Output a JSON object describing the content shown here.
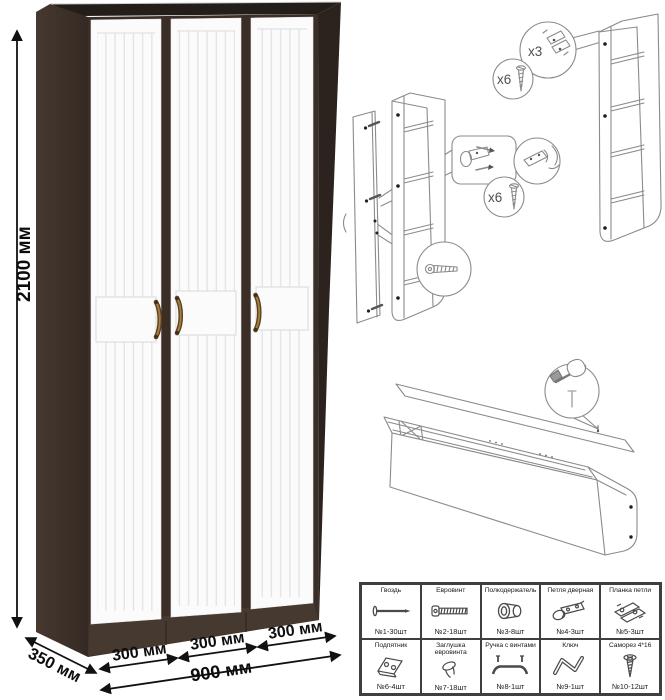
{
  "dimensions": {
    "height": "2100 мм",
    "depth": "350 мм",
    "door_width_1": "300 мм",
    "door_width_2": "300 мм",
    "door_width_3": "300 мм",
    "total_width": "900 мм"
  },
  "assembly": {
    "hinge_plate_qty": "x3",
    "screw_qty_top": "x6",
    "screw_qty_mid": "x6"
  },
  "colors": {
    "wenge_front": "#3a2e27",
    "wenge_top": "#241e1a",
    "wenge_side": "#413329",
    "wenge_right": "#2c231e",
    "plinth": "#463930",
    "door_white": "#fbfbfb",
    "handle_dark": "#5a4122",
    "handle_light": "#a6813e",
    "diagram_line": "#8b8b8b"
  },
  "parts_table": {
    "items": [
      {
        "name": "Гвоздь",
        "count": "№1-30шт",
        "icon": "nail"
      },
      {
        "name": "Евровинт",
        "count": "№2-18шт",
        "icon": "euro-screw"
      },
      {
        "name": "Полкодержатель",
        "count": "№3-8шт",
        "icon": "shelf-support"
      },
      {
        "name": "Петля дверная",
        "count": "№4-3шт",
        "icon": "door-hinge"
      },
      {
        "name": "Планка петли",
        "count": "№5-3шт",
        "icon": "hinge-plate"
      },
      {
        "name": "Подпятник",
        "count": "№6-4шт",
        "icon": "foot-glide"
      },
      {
        "name": "Заглушка евровинта",
        "count": "№7-18шт",
        "icon": "screw-cap"
      },
      {
        "name": "Ручка с винтами",
        "count": "№8-1шт",
        "icon": "handle"
      },
      {
        "name": "Ключ",
        "count": "№9-1шт",
        "icon": "hex-key"
      },
      {
        "name": "Саморез 4*16",
        "count": "№10-12шт",
        "icon": "self-tapping-screw"
      }
    ]
  }
}
